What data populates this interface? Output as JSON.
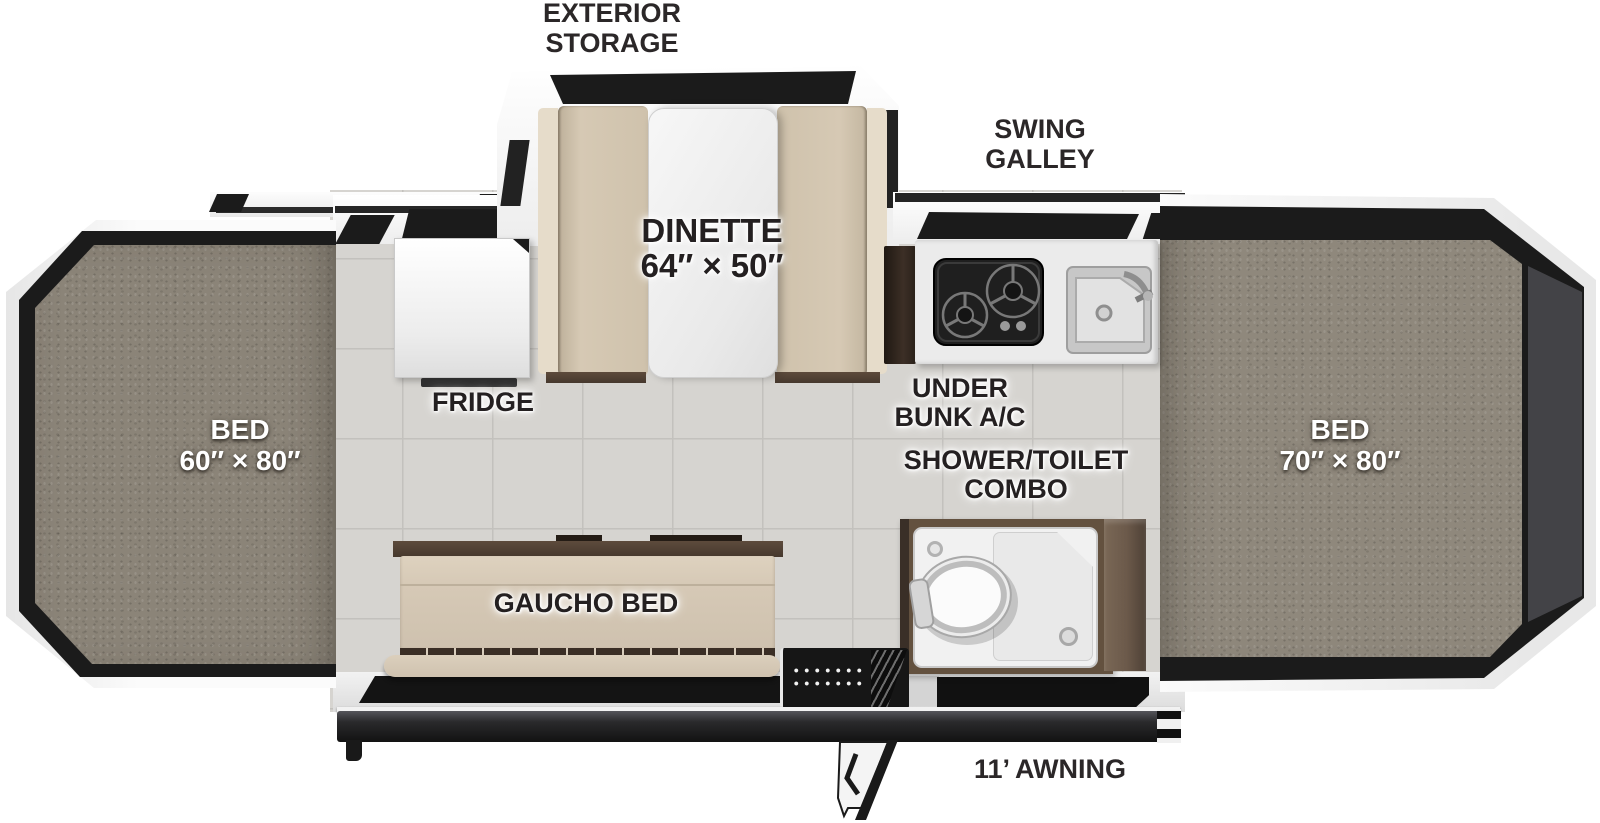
{
  "floorplan": {
    "title": "Pop-up camper floor plan",
    "labels": {
      "exterior_storage": [
        "EXTERIOR",
        "STORAGE"
      ],
      "swing_galley": [
        "SWING",
        "GALLEY"
      ],
      "dinette": [
        "DINETTE",
        "64″ × 50″"
      ],
      "fridge": "FRIDGE",
      "under_bunk_ac": [
        "UNDER",
        "BUNK A/C"
      ],
      "shower_toilet": [
        "SHOWER/TOILET",
        "COMBO"
      ],
      "gaucho_bed": "GAUCHO BED",
      "bed_left": [
        "BED",
        "60″ × 80″"
      ],
      "bed_right": [
        "BED",
        "70″ × 80″"
      ],
      "awning": "11’ AWNING"
    },
    "colors": {
      "background": "#ffffff",
      "floor_tile": "#d6d4d0",
      "tile_grout": "#c3c1bd",
      "carpet": "#8b8478",
      "carpet_right": "#8f887c",
      "panel_black": "#1b1b1b",
      "wall_white": "#f7f7f7",
      "upholstery": "#d3c6b1",
      "upholstery_light": "#e6dcca",
      "wood_dark": "#46382d",
      "wood_cabinet": "#6e5c4a",
      "counter": "#ebebeb",
      "cooktop_black": "#1f1f1f",
      "sink_steel": "#c7c7c7",
      "shower_pan": "#f1f1f1",
      "awning_bar": "#1d1d1f"
    }
  }
}
